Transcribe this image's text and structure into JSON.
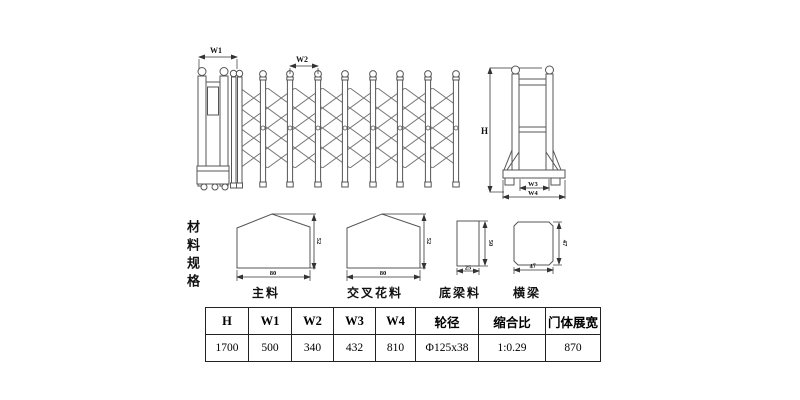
{
  "drawing": {
    "gate_elevation": {
      "dim_w1": "W1",
      "dim_w2": "W2"
    },
    "side_view": {
      "dim_h": "H",
      "dim_w3": "W3",
      "dim_w4": "W4"
    }
  },
  "materials": {
    "section_label": "材料规格",
    "profiles": [
      {
        "name": "主料",
        "width": "80",
        "height": "52"
      },
      {
        "name": "交叉花料",
        "width": "80",
        "height": "52"
      },
      {
        "name": "底梁料",
        "width": "25",
        "height": "50"
      },
      {
        "name": "横梁",
        "width": "47",
        "height": "47"
      }
    ]
  },
  "spec_table": {
    "headers": [
      "H",
      "W1",
      "W2",
      "W3",
      "W4",
      "轮径",
      "缩合比",
      "门体展宽"
    ],
    "values": [
      "1700",
      "500",
      "340",
      "432",
      "810",
      "Φ125x38",
      "1:0.29",
      "870"
    ]
  },
  "colors": {
    "line": "#555555",
    "dim_line": "#333333",
    "text": "#111111",
    "background": "#ffffff"
  }
}
